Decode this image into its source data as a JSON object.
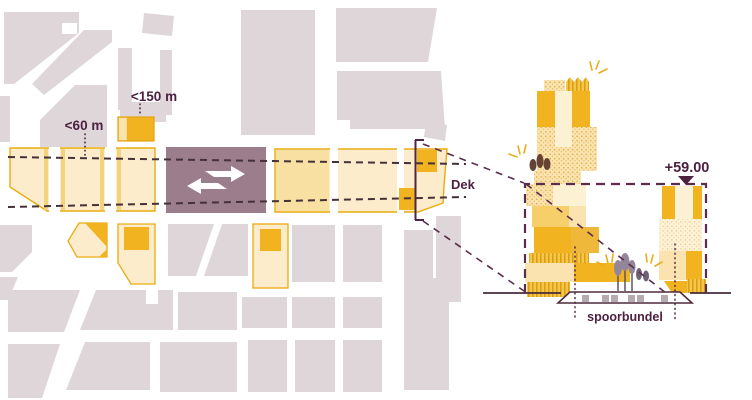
{
  "diagram_type": "urban plan with rail station zone (left) and building-height section (right)",
  "plan": {
    "label_60": "<60 m",
    "label_150": "<150 m",
    "deck_label": "Dek",
    "station_logo": "ns-railways-logo"
  },
  "section": {
    "height_marker_label": "+59.00",
    "rail_bundle_label": "spoorbundel"
  },
  "colors": {
    "block_gray": "#ded6d8",
    "zone_fill": "#fceccb",
    "zone_stroke": "#e9ac10",
    "accent_amber": "#f1b31f",
    "mid_yellow": "#f6ce6a",
    "light_yellow": "#fae3ae",
    "cream": "#fdf1d4",
    "station_mauve": "#9b7d8b",
    "ink_purple": "#4d2140",
    "projection_purple": "#5a2d4d",
    "map_dash": "#443139",
    "tree_brown": "#654233",
    "tree_gray": "#93869a",
    "deck_opening_gray": "#b6abb1"
  }
}
